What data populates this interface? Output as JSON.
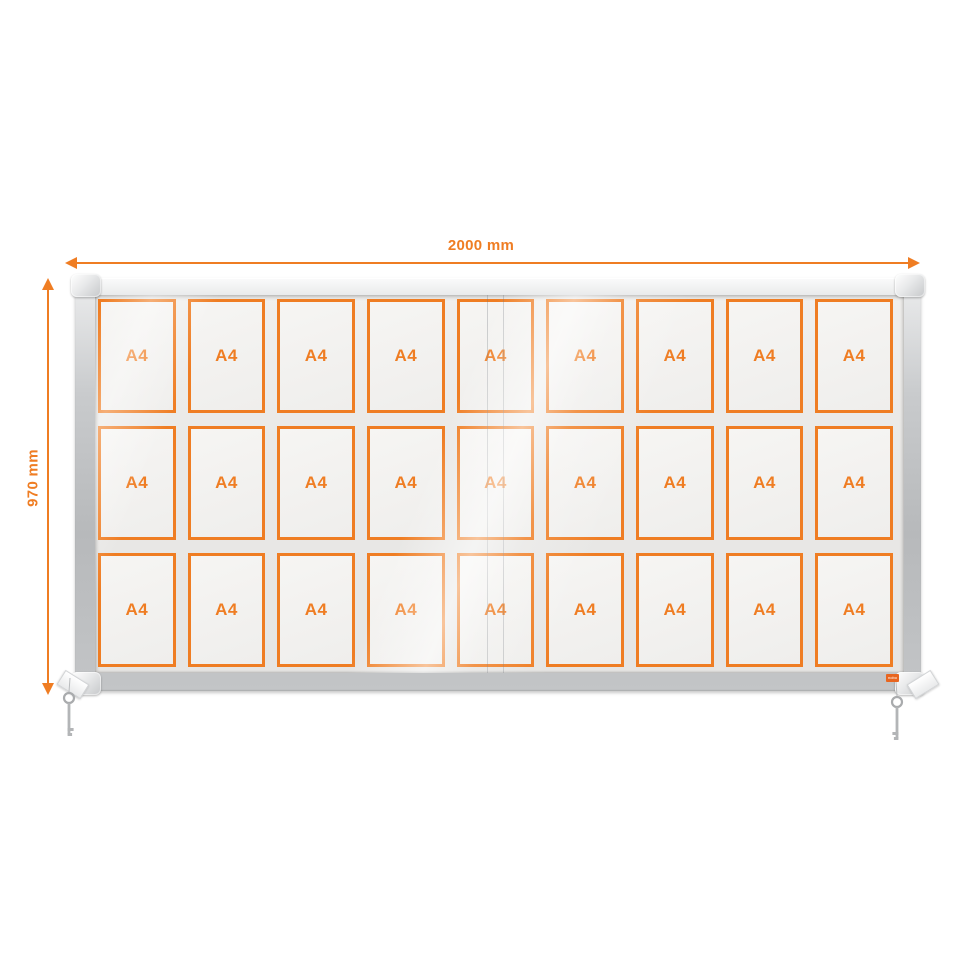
{
  "dimensions": {
    "width_label": "2000 mm",
    "height_label": "970 mm",
    "accent_color": "#EF7D23"
  },
  "display_case": {
    "brand_label": "nobo",
    "grid": {
      "rows": 3,
      "columns": 9,
      "cell_count": 27
    },
    "cell_label": "A4",
    "cells": [
      "A4",
      "A4",
      "A4",
      "A4",
      "A4",
      "A4",
      "A4",
      "A4",
      "A4",
      "A4",
      "A4",
      "A4",
      "A4",
      "A4",
      "A4",
      "A4",
      "A4",
      "A4",
      "A4",
      "A4",
      "A4",
      "A4",
      "A4",
      "A4",
      "A4",
      "A4",
      "A4"
    ],
    "colors": {
      "pocket_border": "#EF7D23",
      "frame_silver": "#C9CBCD",
      "glass_interior": "#E9E8E6",
      "pocket_fill": "#F3F2F0"
    },
    "keys_visible": 2
  }
}
